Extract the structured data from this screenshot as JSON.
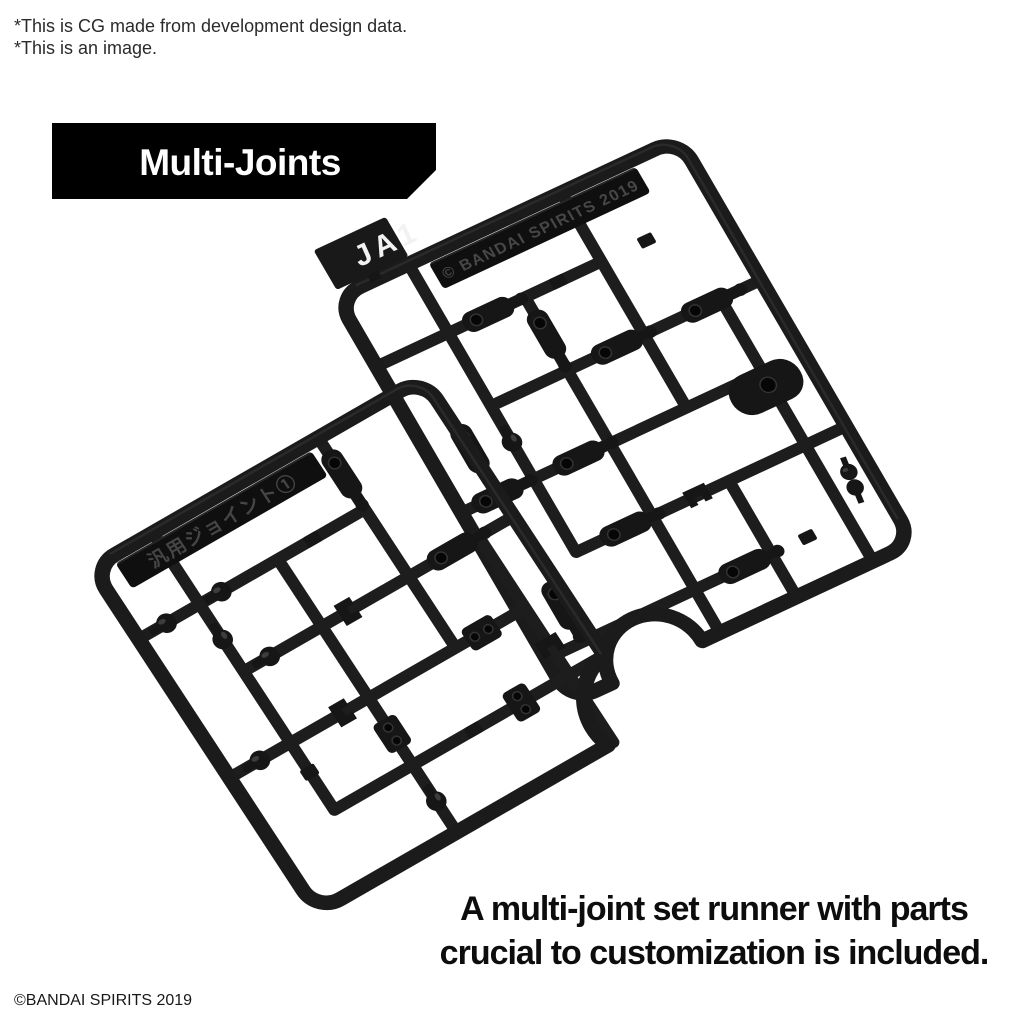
{
  "disclaimer": {
    "line1": "*This is CG made from development design data.",
    "line2": "*This is an image."
  },
  "banner": {
    "label": "Multi-Joints"
  },
  "runner_a": {
    "tag_label": "JA1",
    "embossed_label": "© BANDAI SPIRITS 2019"
  },
  "runner_b": {
    "embossed_label": "汎用ジョイント①"
  },
  "caption": {
    "line1": "A multi-joint set runner with parts",
    "line2": "crucial to customization is included."
  },
  "footer": {
    "copyright": "©BANDAI SPIRITS 2019"
  },
  "colors": {
    "background": "#ffffff",
    "plastic": "#1b1b1b",
    "plastic_dark": "#151515",
    "banner_bg": "#000000",
    "banner_text": "#ffffff",
    "body_text": "#0d0d0d",
    "embossed_text": "#474747"
  }
}
